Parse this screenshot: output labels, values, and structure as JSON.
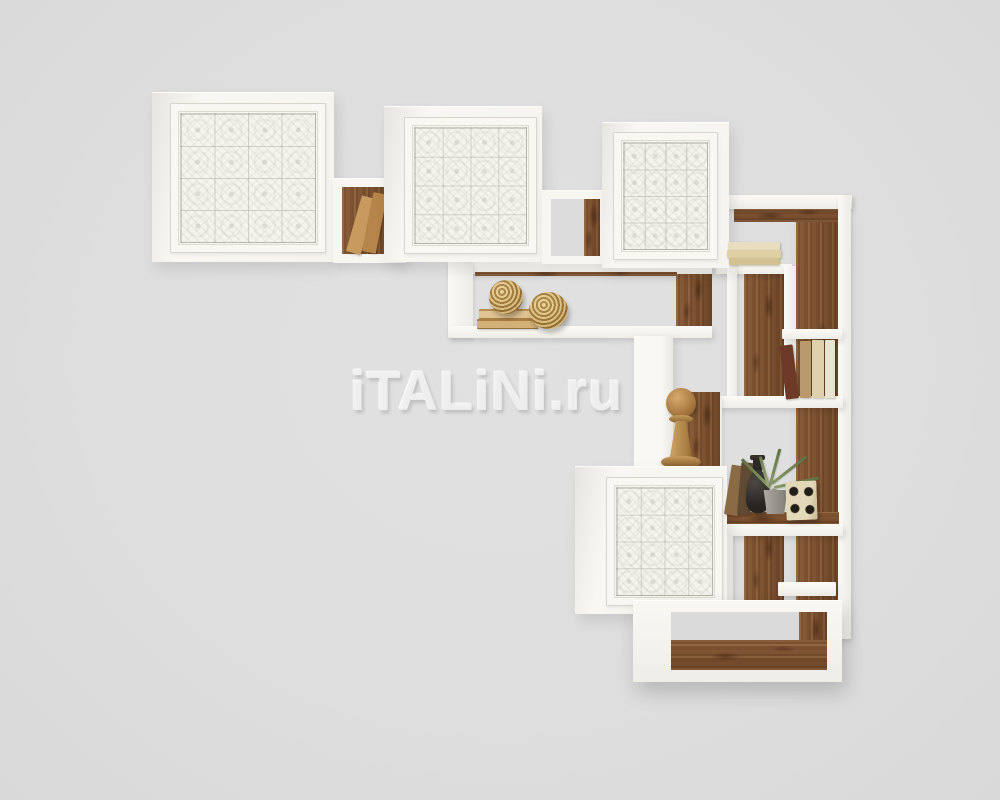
{
  "watermark": {
    "text": "iTALiNi.ru"
  },
  "palette": {
    "background": "#dedede",
    "furniture_white": "#f7f6f1",
    "wood_brown": "#7a5233",
    "book_tan": "#c9a36a",
    "rope_straw": "#c2985e",
    "vase_black": "#2b2825",
    "plant_green": "#78895a",
    "dice_cream": "#e0d5b5",
    "pot_gray": "#9a968f"
  },
  "scene": {
    "subject": "modular wall bookcase with white tile-patterned doors and open wood-lined compartments",
    "decor_items": [
      "leaning books",
      "stacked books",
      "rope knot balls",
      "wooden pawn finial",
      "black bottle vase",
      "air plant in gray pot",
      "dice box"
    ]
  }
}
